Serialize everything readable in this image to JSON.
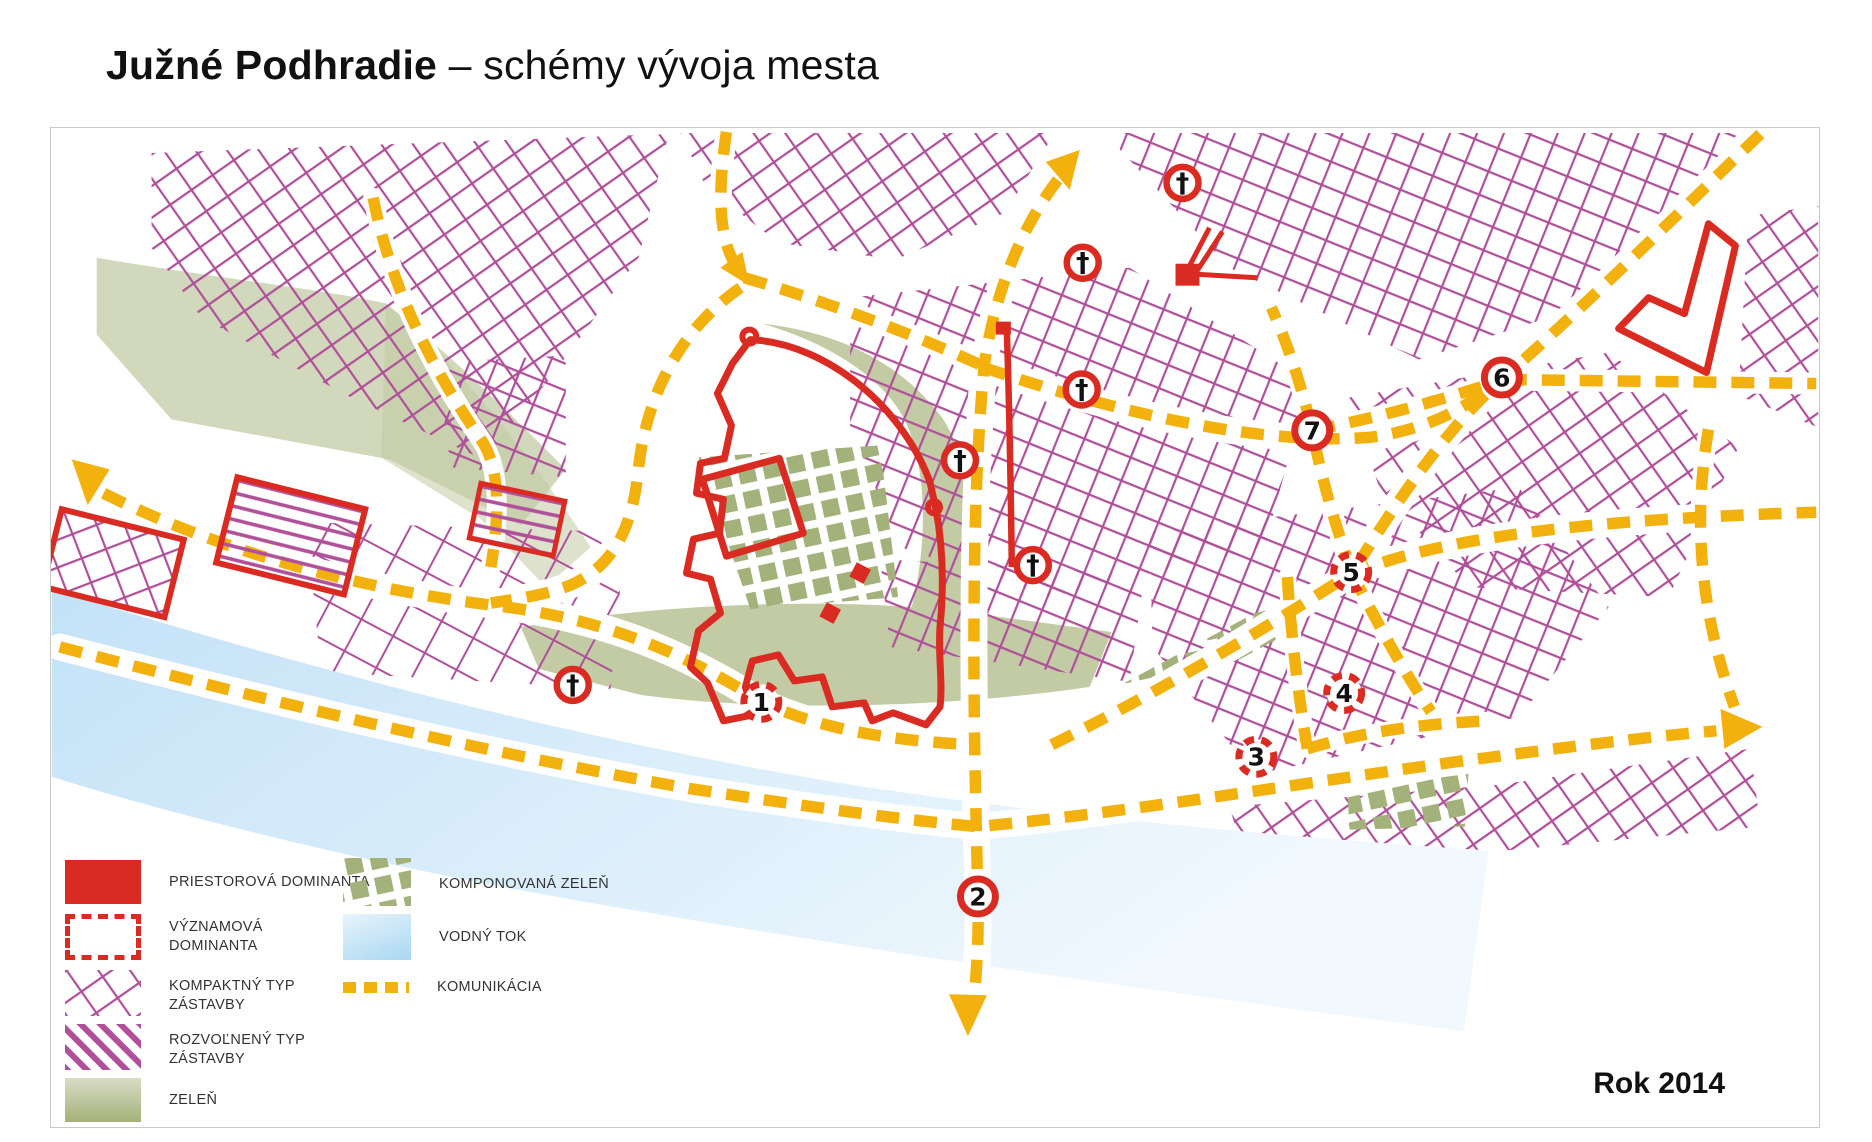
{
  "title": {
    "bold": "Južné Podhradie",
    "rest": " – schémy vývoja mesta"
  },
  "year_label": "Rok 2014",
  "colors": {
    "magenta": "#b0509a",
    "red": "#d92b21",
    "road_yellow": "#f2b10c",
    "olive_green": "#c2cba4",
    "composed_green": "#a3b27b",
    "water_dark": "#c3e2f7",
    "water_light": "#f2f9fe",
    "frame_border": "#c9c9c9"
  },
  "legend": {
    "left": [
      {
        "id": "priestorova-dominanta",
        "swatch": "solid-red-rect",
        "label": "PRIESTOROVÁ DOMINANTA",
        "label2": ""
      },
      {
        "id": "vyznamova-dominanta",
        "swatch": "dashed-red-outline",
        "label": "VÝZNAMOVÁ",
        "label2": "DOMINANTA"
      },
      {
        "id": "kompaktny-typ",
        "swatch": "magenta-crosshatch",
        "label": "KOMPAKTNÝ TYP",
        "label2": "ZÁSTAVBY"
      },
      {
        "id": "rozvolneny-typ",
        "swatch": "magenta-stripes",
        "label": "ROZVOĽNENÝ TYP",
        "label2": "ZÁSTAVBY"
      },
      {
        "id": "zelen",
        "swatch": "olive-rect",
        "label": "ZELEŇ",
        "label2": ""
      }
    ],
    "right": [
      {
        "id": "komponovana-zelen",
        "swatch": "green-checker",
        "label": "KOMPONOVANÁ ZELEŇ"
      },
      {
        "id": "vodny-tok",
        "swatch": "blue-gradient",
        "label": "VODNÝ TOK"
      },
      {
        "id": "komunikacia",
        "swatch": "yellow-dashed-line",
        "label": "KOMUNIKÁCIA"
      }
    ]
  },
  "map": {
    "church_symbol": "†",
    "churches": [
      {
        "x": 1133,
        "y": 55
      },
      {
        "x": 1033,
        "y": 135
      },
      {
        "x": 1032,
        "y": 262
      },
      {
        "x": 910,
        "y": 333
      },
      {
        "x": 983,
        "y": 438
      },
      {
        "x": 522,
        "y": 558
      }
    ],
    "landmarks": [
      {
        "n": "1",
        "x": 711,
        "y": 575,
        "ring": "dashed"
      },
      {
        "n": "2",
        "x": 928,
        "y": 770,
        "ring": "solid"
      },
      {
        "n": "3",
        "x": 1207,
        "y": 630,
        "ring": "dashed"
      },
      {
        "n": "4",
        "x": 1295,
        "y": 566,
        "ring": "dashed"
      },
      {
        "n": "5",
        "x": 1302,
        "y": 445,
        "ring": "dashed"
      },
      {
        "n": "6",
        "x": 1453,
        "y": 250,
        "ring": "solid"
      },
      {
        "n": "7",
        "x": 1263,
        "y": 303,
        "ring": "solid"
      }
    ]
  }
}
